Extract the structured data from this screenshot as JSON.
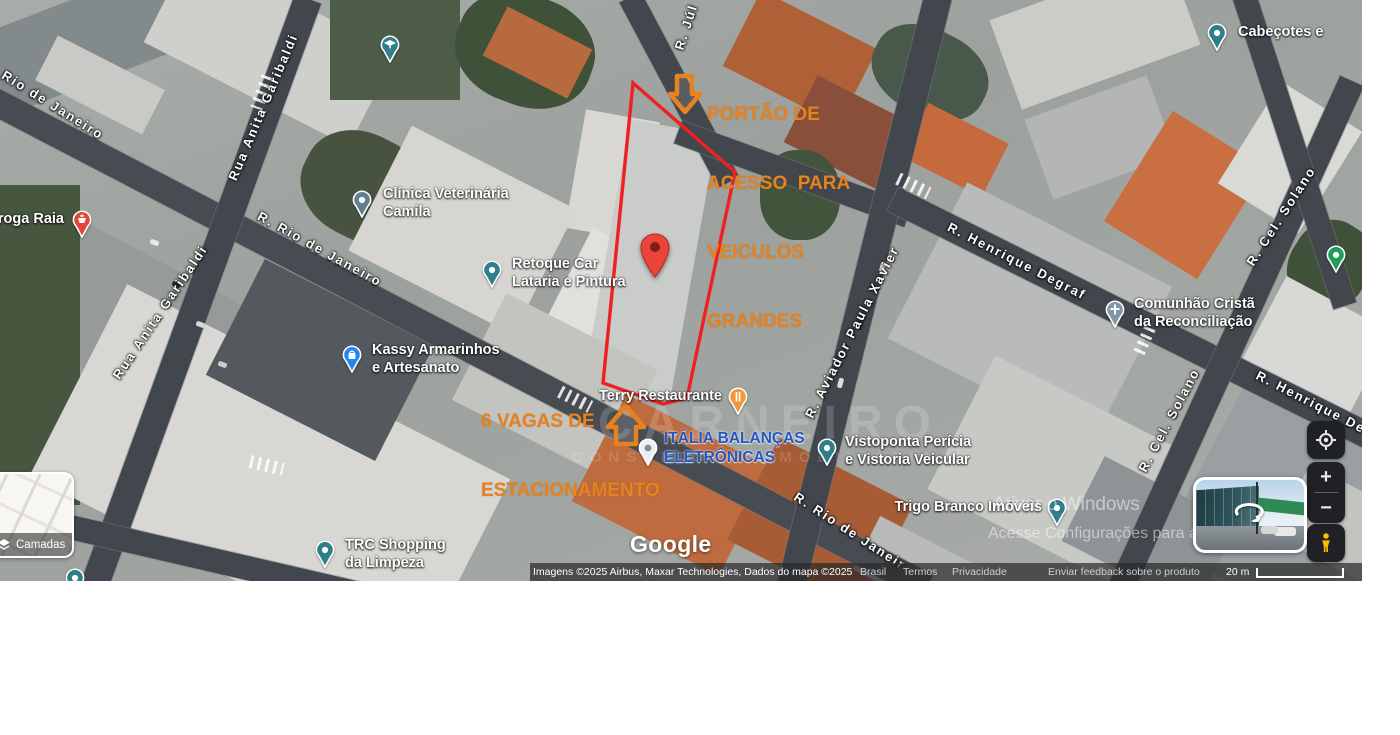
{
  "annotations": {
    "gate": {
      "lines": [
        "PORTÃO DE",
        "ACESSO  PARA",
        "VEICULOS",
        "GRANDES"
      ],
      "color": "#E8821E"
    },
    "parking": {
      "lines": [
        "6 VAGAS DE",
        "ESTACIONAMENTO"
      ],
      "color": "#E8821E"
    }
  },
  "streets": [
    {
      "name": "Rio de Janeiro",
      "x": 53,
      "y": 105,
      "angle": 32
    },
    {
      "name": "Rua Anita Garibaldi",
      "x": 263,
      "y": 107,
      "angle": -67
    },
    {
      "name": "Rua Anita Garibaldi",
      "x": 160,
      "y": 312,
      "angle": -56
    },
    {
      "name": "R. Rio de Janeiro",
      "x": 320,
      "y": 249,
      "angle": 29
    },
    {
      "name": "R. Júl",
      "x": 686,
      "y": 27,
      "angle": -72
    },
    {
      "name": "R. Aviador Paula Xavier",
      "x": 852,
      "y": 332,
      "angle": -63
    },
    {
      "name": "R. Henrique Degraf",
      "x": 1017,
      "y": 261,
      "angle": 27
    },
    {
      "name": "R. Cel. Solano",
      "x": 1281,
      "y": 216,
      "angle": -57
    },
    {
      "name": "R. Cel. Solano",
      "x": 1169,
      "y": 420,
      "angle": -62
    },
    {
      "name": "R. Henrique De",
      "x": 1311,
      "y": 402,
      "angle": 27
    },
    {
      "name": "R. Rio de Janeir",
      "x": 850,
      "y": 531,
      "angle": 33
    }
  ],
  "places": [
    {
      "pin": "school-pin",
      "x": 390,
      "y": 45,
      "lines": []
    },
    {
      "pin": "pharmacy-pin",
      "x": 82,
      "y": 220,
      "lines": [
        "roga Raia"
      ],
      "tx": 64,
      "ty": 211,
      "align": "right"
    },
    {
      "pin": "clinic-pin",
      "x": 362,
      "y": 200,
      "lines": [
        "Clínica Veterinária",
        "Camila"
      ],
      "tx": 383,
      "ty": 186
    },
    {
      "pin": "generic-pin",
      "x": 492,
      "y": 270,
      "lines": [
        "Retoque Car",
        "Lataria e Pintura"
      ],
      "tx": 512,
      "ty": 256
    },
    {
      "pin": "red-marker-pin",
      "x": 655,
      "y": 255,
      "lines": []
    },
    {
      "pin": "shopping-pin",
      "x": 352,
      "y": 355,
      "lines": [
        "Kassy Armarinhos",
        "e Artesanato"
      ],
      "tx": 372,
      "ty": 342
    },
    {
      "pin": "restaurant-pin",
      "x": 738,
      "y": 397,
      "lines": [
        "Terry Restaurante"
      ],
      "tx": 722,
      "ty": 388,
      "align": "right"
    },
    {
      "pin": "balance-pin",
      "x": 648,
      "y": 448,
      "lines": [
        "ITÁLIA BALANÇAS",
        "ELETRÔNICAS"
      ],
      "tx": 664,
      "ty": 429,
      "cls": "label-blue"
    },
    {
      "pin": "generic-pin",
      "x": 827,
      "y": 448,
      "lines": [
        "Vistoponta Perícia",
        "e Vistoria Veicular"
      ],
      "tx": 845,
      "ty": 434
    },
    {
      "pin": "generic-pin",
      "x": 1057,
      "y": 508,
      "lines": [
        "Trigo Branco Imóveis"
      ],
      "tx": 1042,
      "ty": 499,
      "align": "right"
    },
    {
      "pin": "church-pin",
      "x": 1115,
      "y": 310,
      "lines": [
        "Comunhão Cristã",
        "da Reconciliação"
      ],
      "tx": 1134,
      "ty": 296
    },
    {
      "pin": "generic-pin",
      "x": 1217,
      "y": 33,
      "lines": [
        "Cabeçotes e"
      ],
      "tx": 1238,
      "ty": 24
    },
    {
      "pin": "park-pin",
      "x": 1336,
      "y": 255,
      "lines": []
    },
    {
      "pin": "generic-pin",
      "x": 325,
      "y": 550,
      "lines": [
        "TRC Shopping",
        "da Limpeza"
      ],
      "tx": 345,
      "ty": 537
    },
    {
      "pin": "generic-pin",
      "x": 75,
      "y": 578,
      "lines": []
    }
  ],
  "watermarks": {
    "brand_big": "CARNEIRO",
    "brand_small": "CONSULTORIA IMOBILIÁRIA",
    "windows_line1": "Ativar o Windows",
    "windows_line2": "Acesse Configurações para ativar o Windows."
  },
  "google_logo": "Google",
  "attribution": {
    "imagery": "Imagens ©2025 Airbus, Maxar Technologies, Dados do mapa ©2025",
    "links": [
      "Brasil",
      "Termos",
      "Privacidade",
      "Enviar feedback sobre o produto"
    ],
    "scale_label": "20 m"
  },
  "controls": {
    "layers_label": "Camadas",
    "zoom_in": "+",
    "zoom_out": "−"
  }
}
